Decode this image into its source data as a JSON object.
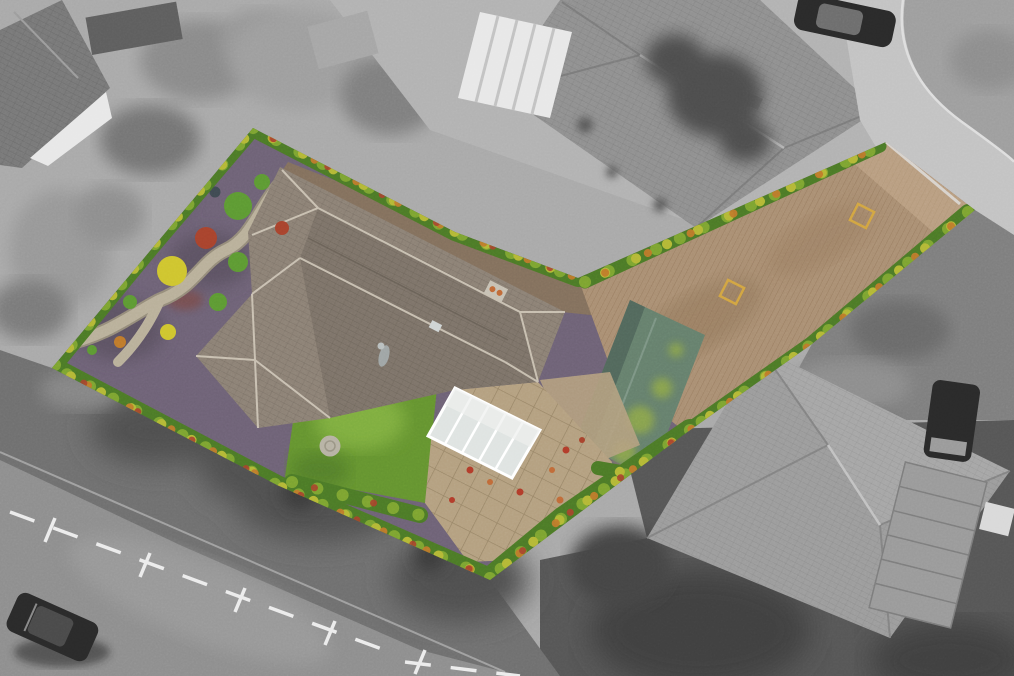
{
  "meta": {
    "type": "drone aerial photograph of a residential property",
    "effect": "featured plot rendered in full colour while the surrounding neighbourhood is desaturated to greyscale",
    "canvas": {
      "width": 1014,
      "height": 676
    }
  },
  "palette": {
    "canvas_gray": "#a9a9a9",
    "verge_gray": "#6f6f6f",
    "road_dark_gray": "#8e8e8e",
    "road_light_gray": "#c3c3c3",
    "apron_gray": "#b2b2b2",
    "roof_gray_dark": "#787878",
    "roof_gray_mid": "#909090",
    "roof_gray_light": "#9c9c9c",
    "skylight_white": "#e8e8e8",
    "marking_white": "#ececec",
    "car_black": "#2a2a2a",
    "shadow_gray": "#4e4e4e",
    "gravel_purple": "#6e6276",
    "garden_path_beige": "#b9b09a",
    "house_roof_brown": "#8c8175",
    "roof_ridge_light": "#d4ccbd",
    "chimney_gray": "#c7c1b4",
    "chimney_pot_orange": "#c06a38",
    "conservatory_white": "#eef0ee",
    "conservatory_panel": "#dfe4e2",
    "lawn_green": "#659430",
    "lawn_light_green": "#7fae3f",
    "stone_circle_gray": "#b7b2a4",
    "patio_beige": "#b4a080",
    "soil_brown": "#83705d",
    "driveway_tan": "#aa8f73",
    "driveway_light_tan": "#c4ac8d",
    "shed_green": "#66806d",
    "shed_moss_green": "#8fa84a",
    "hedge_green": "#4c7a27",
    "hedge_light_green": "#7da431",
    "hedge_yellow": "#b4b836",
    "hedge_orange": "#bf7a2b",
    "hedge_red": "#a8432d",
    "shrub_green": "#5d9a33",
    "shrub_yellow": "#cfc52f",
    "flower_red": "#b23c2a",
    "marker_gold": "#d8a93e",
    "fence_white": "#e0e0e0",
    "statue_gray": "#9fa5a5"
  },
  "property": {
    "boundary_points": "253,128 455,232 578,278 886,142 975,210 812,344 686,433 490,580 277,485 52,368",
    "house_footprint_points": "280,167 565,312 538,382 455,390 330,418 258,428 196,356 252,294 248,232",
    "driveway_points": "578,278 886,142 975,210 812,344 686,433 612,372",
    "lawn_points": "300,373 437,388 425,503 285,477",
    "patio_points": "425,503 432,430 455,390 538,382 612,462 596,556 468,562",
    "shed_points": "630,300 705,335 650,478 575,442",
    "conservatory_points": "455,388 540,430 512,478 428,436",
    "soil_strip_points": "288,162 578,276 600,316 562,312 280,174",
    "features": [
      "bungalow with multi-hipped brown tiled roof and chimney",
      "white conservatory on rear elevation",
      "rear lawn with circular stone feature",
      "paved patio with potted plants",
      "purple gravel front garden with winding path and round shrubs",
      "long brick driveway lined with autumn hedges",
      "weathered green garage roof",
      "two gold plot markers on the driveway"
    ]
  },
  "surroundings": {
    "features": [
      "grey hip-roofed neighbouring houses top-centre and bottom-right",
      "house with white rooflights top-left",
      "white conservatory on neighbouring house top-centre",
      "curving estate road with parked dark car top-right",
      "main road with white parking-bay markings and dark car bottom-left",
      "ribbed garage roof and dark van bottom-right",
      "mature trees casting soft shadows"
    ]
  }
}
